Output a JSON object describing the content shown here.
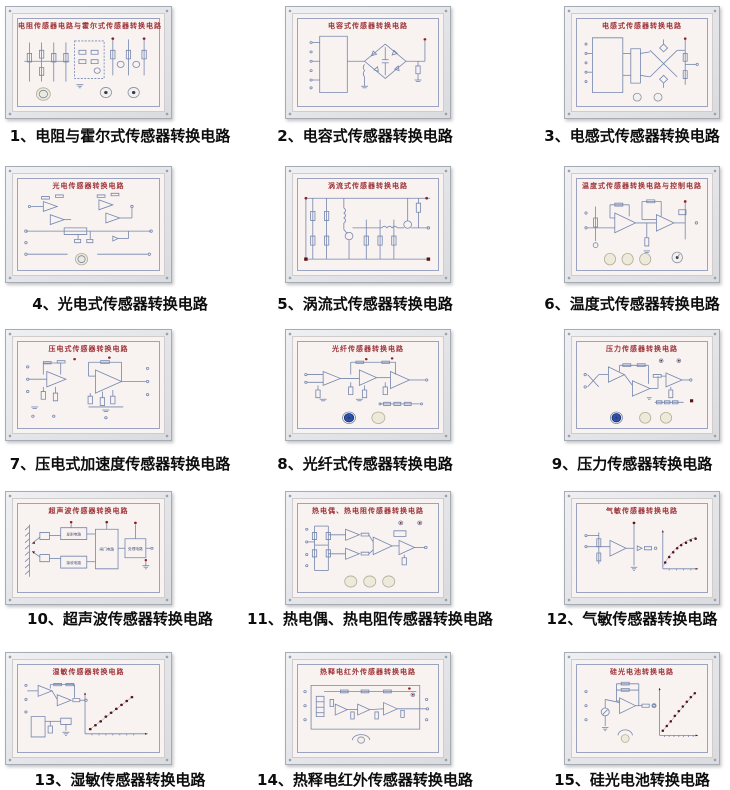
{
  "colors": {
    "panel_title": "#9e3238",
    "circuit_line": "#7486ae",
    "caption_text": "#0d0d0d",
    "panel_face": "#f8f2f0",
    "frame_silver": "#dfe1e5",
    "accent_red_dot": "#8a2020",
    "knob_blue": "#2a4fae",
    "knob_white": "#eeeadb"
  },
  "panels": [
    {
      "num": "1",
      "panel_title": "电阻传感器电路与霍尔式传感器转换电路",
      "caption": "1、电阻与霍尔式传感器转换电路"
    },
    {
      "num": "2",
      "panel_title": "电容式传感器转换电路",
      "caption": "2、电容式传感器转换电路"
    },
    {
      "num": "3",
      "panel_title": "电感式传感器转换电路",
      "caption": "3、电感式传感器转换电路"
    },
    {
      "num": "4",
      "panel_title": "光电传感器转换电路",
      "caption": "4、光电式传感器转换电路"
    },
    {
      "num": "5",
      "panel_title": "涡流式传感器转换电路",
      "caption": "5、涡流式传感器转换电路"
    },
    {
      "num": "6",
      "panel_title": "温度式传感器转换电路与控制电路",
      "caption": "6、温度式传感器转换电路"
    },
    {
      "num": "7",
      "panel_title": "压电式传感器转换电路",
      "caption": "7、压电式加速度传感器转换电路"
    },
    {
      "num": "8",
      "panel_title": "光纤传感器转换电路",
      "caption": "8、光纤式传感器转换电路"
    },
    {
      "num": "9",
      "panel_title": "压力传感器转换电路",
      "caption": "9、压力传感器转换电路"
    },
    {
      "num": "10",
      "panel_title": "超声波传感器转换电路",
      "caption": "10、超声波传感器转换电路",
      "blocks": [
        "发射电路",
        "接收电路",
        "闸门电路",
        "处理电路"
      ]
    },
    {
      "num": "11",
      "panel_title": "热电偶、热电阻传感器转换电路",
      "caption": "11、热电偶、热电阻传感器转换电路"
    },
    {
      "num": "12",
      "panel_title": "气敏传感器转换电路",
      "caption": "12、气敏传感器转换电路"
    },
    {
      "num": "13",
      "panel_title": "湿敏传感器转换电路",
      "caption": "13、湿敏传感器转换电路"
    },
    {
      "num": "14",
      "panel_title": "热释电红外传感器转换电路",
      "caption": "14、热释电红外传感器转换电路"
    },
    {
      "num": "15",
      "panel_title": "硅光电池转换电路",
      "caption": "15、硅光电池转换电路"
    }
  ]
}
